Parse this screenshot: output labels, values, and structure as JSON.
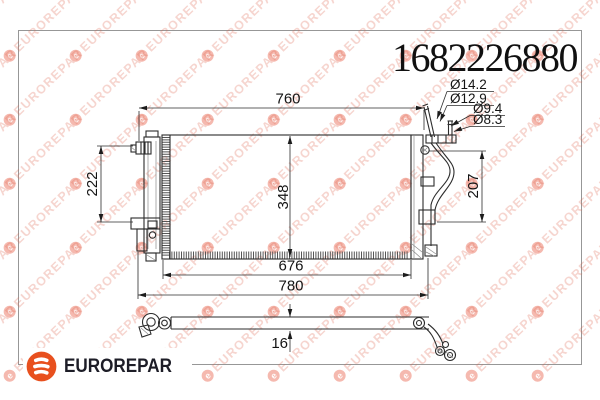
{
  "part_number": "1682226880",
  "brand": {
    "name": "EUROREPAR",
    "logo_letter": "e"
  },
  "watermark": {
    "text": "EUROREPAR",
    "icon_letter": "e"
  },
  "drawing": {
    "dimensions": {
      "top_width": "760",
      "core_width": "676",
      "overall_width": "780",
      "core_height": "348",
      "left_span": "222",
      "right_span": "207",
      "thickness": "16"
    },
    "ports": {
      "d1": "Ø14.2",
      "d2": "Ø12.9",
      "d3": "Ø9.4",
      "d4": "Ø8.3"
    }
  },
  "colors": {
    "brand_orange": "#E8501E",
    "logo_text_dark": "#1D1D27",
    "watermark_salmon": "#F2A095",
    "frame_gray": "#979797",
    "line_color": "#2C2C2C"
  }
}
